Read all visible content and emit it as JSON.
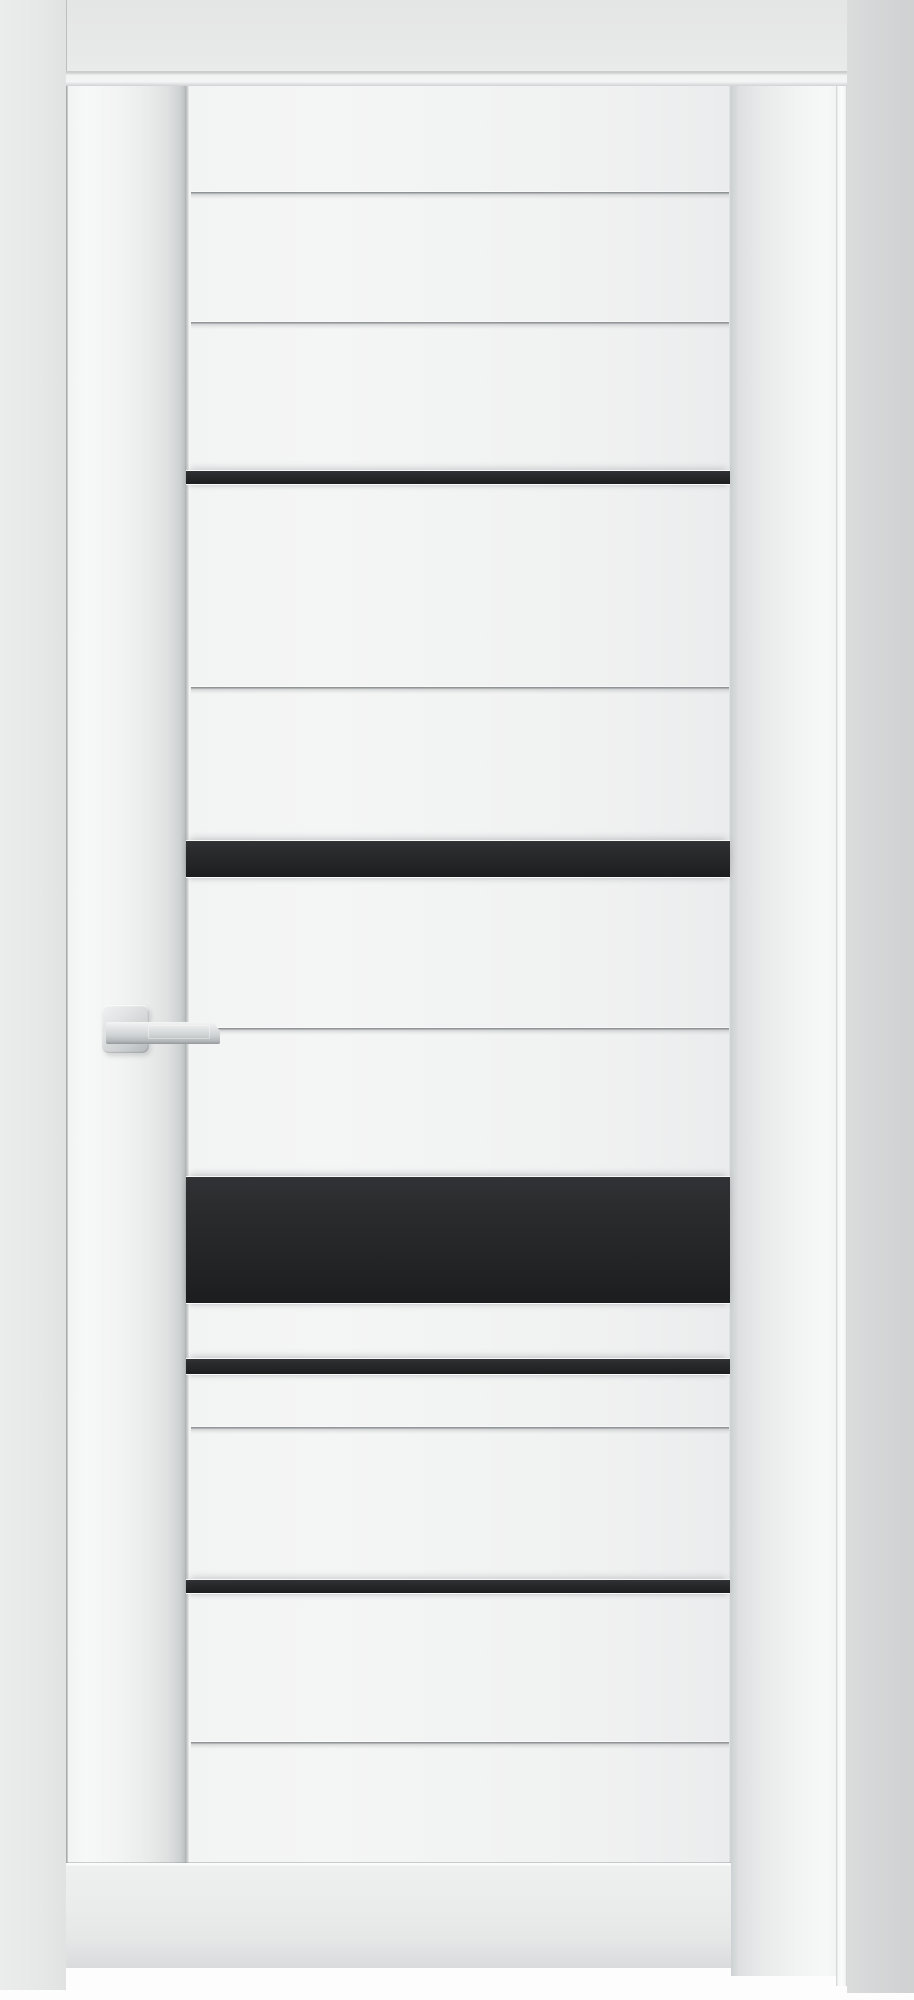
{
  "scene": {
    "description": "Product photo: closed white interior door with five horizontal black glass inserts, horizontal milled grooves, square-rose satin lever handle on the left stile, white frame, gray walls, white floor"
  },
  "colors": {
    "floor_white": "#fdfdfe",
    "wall_left_gray": "#e7e8e8",
    "wall_right_gray": "#d5d6d7",
    "frame_white": "#f2f3f3",
    "leaf_white": "#f3f4f4",
    "glass_black": "#232426",
    "handle_metal": "#ced1d3"
  },
  "rects": {
    "floor": {
      "x": 0,
      "y": 1960,
      "w": 914,
      "h": 40
    },
    "wall_left": {
      "x": 0,
      "y": 0,
      "w": 66,
      "h": 1990
    },
    "wall_above": {
      "x": 66,
      "y": 0,
      "w": 781,
      "h": 72
    },
    "wall_right": {
      "x": 847,
      "y": 0,
      "w": 67,
      "h": 1993
    },
    "head_jamb": {
      "x": 66,
      "y": 71,
      "w": 781,
      "h": 15
    },
    "right_jamb": {
      "x": 731,
      "y": 86,
      "w": 105,
      "h": 1890
    },
    "jamb_edge": {
      "x": 836,
      "y": 86,
      "w": 11,
      "h": 1900
    },
    "leaf": {
      "x": 66,
      "y": 86,
      "w": 665,
      "h": 1882
    },
    "left_seam": {
      "x": 0,
      "y": 0,
      "w": 2,
      "h": 1882
    },
    "stile": {
      "x": 2,
      "y": 0,
      "w": 117,
      "h": 1882
    },
    "stile_seam": {
      "x": 119,
      "y": 0,
      "w": 6,
      "h": 1882
    },
    "right_edge": {
      "x": 663,
      "y": 0,
      "w": 2,
      "h": 1882
    },
    "bottom_rail": {
      "x": 0,
      "y": 1777,
      "w": 665,
      "h": 105
    },
    "rose": {
      "x": 36,
      "y": 919,
      "w": 47,
      "h": 48
    },
    "lever": {
      "x": 40,
      "y": 936,
      "w": 114,
      "h": 22
    }
  },
  "door": {
    "groove_geom": {
      "x": 125,
      "w": 538,
      "h": 7
    },
    "grooves_y": [
      106,
      236,
      601,
      942,
      1341,
      1656
    ],
    "strip_geom": {
      "x": 120,
      "w": 544
    },
    "glass_strips": [
      {
        "y": 385,
        "h": 13
      },
      {
        "y": 755,
        "h": 36
      },
      {
        "y": 1091,
        "h": 126
      },
      {
        "y": 1273,
        "h": 15
      },
      {
        "y": 1494,
        "h": 13
      }
    ]
  }
}
